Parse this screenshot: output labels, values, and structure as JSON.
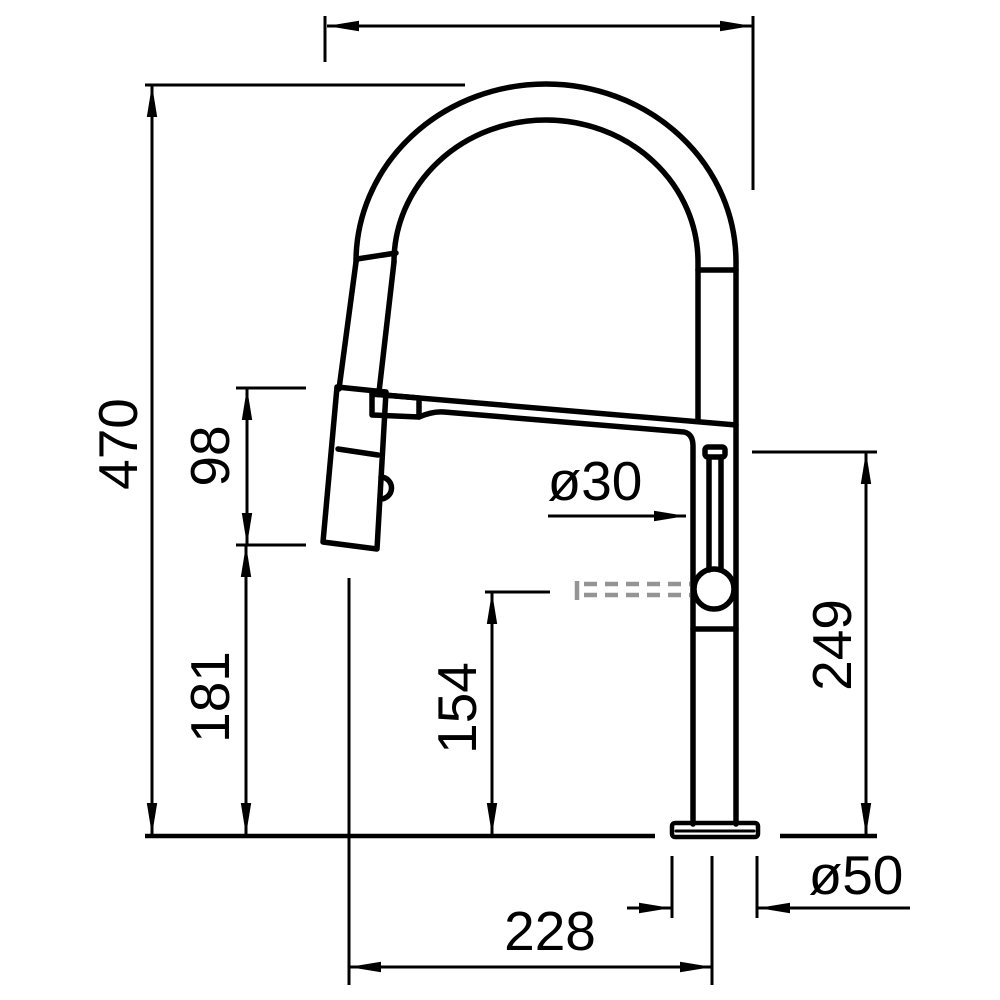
{
  "drawing": {
    "kind": "faucet-dimension-drawing",
    "colors": {
      "line": "#000000",
      "phantom": "#949494",
      "background": "#ffffff"
    },
    "labels": {
      "overall_height": "470",
      "spray_head_length": "98",
      "spray_head_bottom_height": "181",
      "hose_outlet_height": "154",
      "spout_outlet_height": "249",
      "body_diameter": "ø30",
      "base_diameter": "ø50",
      "spout_reach": "228"
    }
  }
}
